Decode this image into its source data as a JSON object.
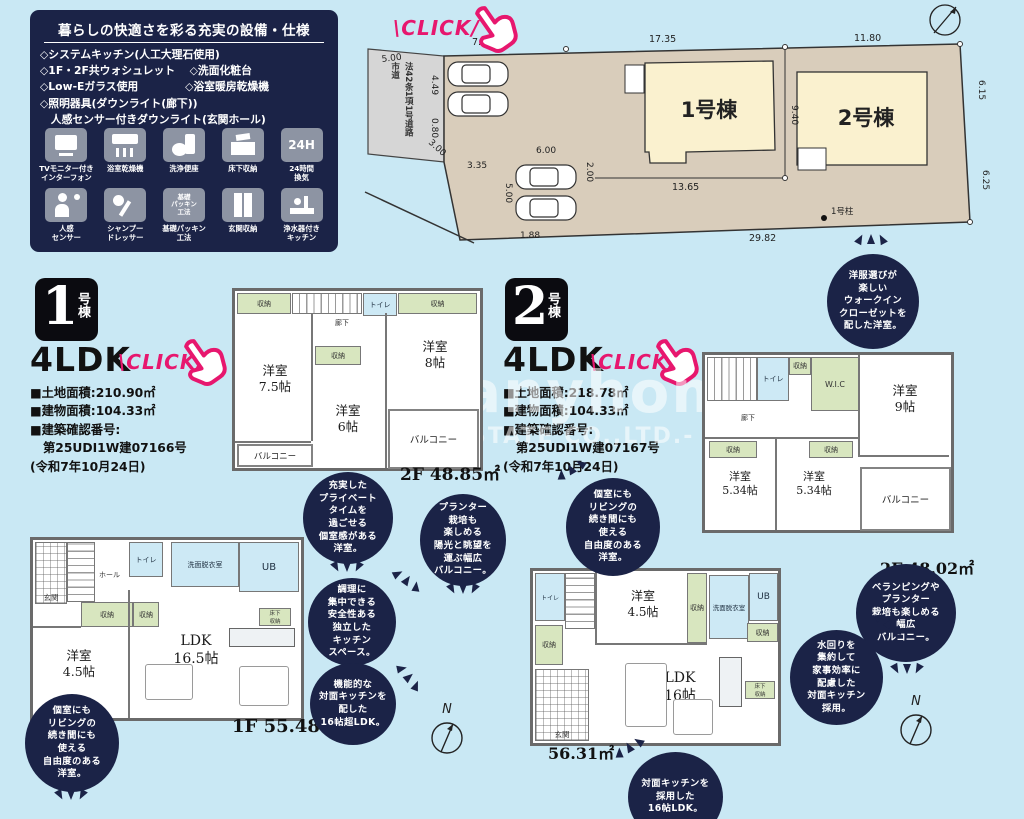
{
  "features_box": {
    "title": "暮らしの快適さを彩る充実の設備・仕様",
    "bullets": [
      "◇システムキッチン(人工大理石使用)",
      "◇1F・2F共ウォシュレット　 ◇洗面化粧台",
      "◇Low-Eガラス使用　　　　 ◇浴室暖房乾燥機",
      "◇照明器具(ダウンライト(廊下))",
      "　人感センサー付きダウンライト(玄関ホール)"
    ],
    "icons": [
      {
        "label": "TVモニター付き\nインターフォン"
      },
      {
        "label": "浴室乾燥機"
      },
      {
        "label": "洗浄便座"
      },
      {
        "label": "床下収納"
      },
      {
        "label": "24時間\n換気",
        "badge": "24H"
      },
      {
        "label": "人感\nセンサー"
      },
      {
        "label": "シャンプー\nドレッサー"
      },
      {
        "label": "基礎パッキン\n工法",
        "badge": "基礎\nパッキン\n工法"
      },
      {
        "label": "玄関収納"
      },
      {
        "label": "浄水器付き\nキッチン"
      }
    ]
  },
  "click_label": "\\CLICK/",
  "site_plan": {
    "building1": "1号棟",
    "building2": "2号棟",
    "pillar": "1号柱",
    "road_text": "法42条1項1号道路\n市道",
    "north": "N",
    "dims": {
      "t764": "7.64",
      "t1735": "17.35",
      "t1180": "11.80",
      "l500": "5.00",
      "l449": "4.49",
      "l080": "0.80",
      "d300": "3.00",
      "d335": "3.35",
      "d600": "6.00",
      "d200": "2.00",
      "d500": "5.00",
      "d188": "1.88",
      "d1365": "13.65",
      "d940": "9.40",
      "r615": "6.15",
      "r625": "6.25",
      "b2982": "29.82"
    }
  },
  "unit1": {
    "number": "1",
    "suffix": "号棟",
    "layout": "4LDK",
    "land": "■土地面積:210.90㎡",
    "building": "■建物面積:104.33㎡",
    "confirm": "■建築確認番号:",
    "confirm_no": "第25UDI1W建07166号",
    "confirm_date": "(令和7年10月24日)"
  },
  "unit2": {
    "number": "2",
    "suffix": "号棟",
    "layout": "4LDK",
    "land": "■土地面積:218.78㎡",
    "building": "■建物面積:104.33㎡",
    "confirm": "■建築確認番号:",
    "confirm_no": "第25UDI1W建07167号",
    "confirm_date": "(令和7年10月24日)"
  },
  "plans": {
    "labels": {
      "closet": "収納",
      "toilet": "トイレ",
      "hall": "廊下",
      "balcony": "バルコニー",
      "ub": "UB",
      "wash": "洗面脱衣室",
      "entrance": "玄関",
      "hall1f": "ホール",
      "wic": "W.I.C",
      "underfloor": "床下\n収納"
    },
    "u1f2": {
      "rooms": [
        "洋室\n7.5帖",
        "洋室\n6帖",
        "洋室\n8帖"
      ],
      "area": "2F 48.85㎡"
    },
    "u2f2": {
      "rooms": [
        "洋室\n9帖",
        "洋室\n5.34帖",
        "洋室\n5.34帖"
      ],
      "area": "2F 48.02㎡"
    },
    "u1f1": {
      "rooms": [
        "洋室\n4.5帖",
        "LDK\n16.5帖"
      ],
      "area": "1F 55.48㎡"
    },
    "u2f1": {
      "rooms": [
        "洋室\n4.5帖",
        "LDK\n16帖"
      ],
      "area": "56.31㎡"
    }
  },
  "bubbles": [
    {
      "text": "充実した\nプライベート\nタイムを\n過ごせる\n個室感がある\n洋室。"
    },
    {
      "text": "プランター\n栽培も\n楽しめる\n陽光と眺望を\n運ぶ幅広\nバルコニー。"
    },
    {
      "text": "調理に\n集中できる\n安全性ある\n独立した\nキッチン\nスペース。"
    },
    {
      "text": "機能的な\n対面キッチンを\n配した\n16帖超LDK。"
    },
    {
      "text": "洋服選びが\n楽しい\nウォークイン\nクローゼットを\n配した洋室。"
    },
    {
      "text": "個室にも\nリビングの\n続き間にも\n使える\n自由度のある\n洋室。"
    },
    {
      "text": "ベランピングや\nプランター\n栽培も楽しめる\n幅広\nバルコニー。"
    },
    {
      "text": "水回りを\n集約して\n家事効率に\n配慮した\n対面キッチン\n採用。"
    },
    {
      "text": "個室にも\nリビングの\n続き間にも\n使える\n自由度のある\n洋室。"
    },
    {
      "text": "対面キッチンを\n採用した\n16帖LDK。"
    }
  ],
  "watermark": {
    "line1": "anyhome",
    "line2": "STATE CO.,LTD.-"
  }
}
